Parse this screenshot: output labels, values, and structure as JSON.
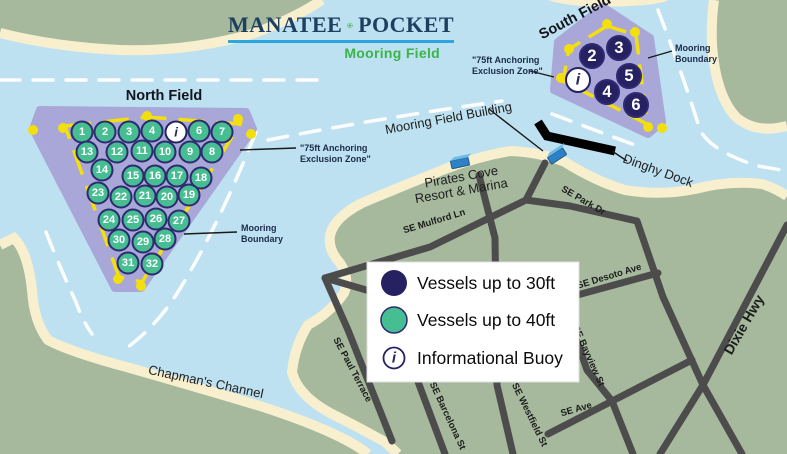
{
  "map_title": {
    "word_left": "MANATEE",
    "word_right": "POCKET",
    "subtitle": "Mooring Field"
  },
  "colors": {
    "water": "#BDE1F0",
    "sand": "#F8EFCE",
    "land": "#A6B99D",
    "field": "#A9A6D8",
    "yellow": "#F2DF0D",
    "street": "#4C4C4C",
    "navy": "#262262",
    "buoy_green": "#47BD92",
    "buoy_stroke": "#2E2A72",
    "title_navy": "#1D3F60",
    "title_green": "#3BB54A",
    "underline": "#2BA7E0",
    "dock_black": "#000000",
    "building_blue": "#2E81C4"
  },
  "north_field": {
    "label": "North Field",
    "buoys": [
      {
        "n": "1",
        "x": 82,
        "y": 132
      },
      {
        "n": "2",
        "x": 105,
        "y": 132
      },
      {
        "n": "3",
        "x": 129,
        "y": 132
      },
      {
        "n": "4",
        "x": 152,
        "y": 131
      },
      {
        "n": "i",
        "x": 176,
        "y": 132,
        "t": "i"
      },
      {
        "n": "6",
        "x": 199,
        "y": 131
      },
      {
        "n": "7",
        "x": 222,
        "y": 132
      },
      {
        "n": "13",
        "x": 87,
        "y": 152
      },
      {
        "n": "12",
        "x": 117,
        "y": 152
      },
      {
        "n": "11",
        "x": 142,
        "y": 151
      },
      {
        "n": "10",
        "x": 165,
        "y": 152
      },
      {
        "n": "9",
        "x": 190,
        "y": 152
      },
      {
        "n": "8",
        "x": 212,
        "y": 152
      },
      {
        "n": "14",
        "x": 102,
        "y": 170
      },
      {
        "n": "15",
        "x": 133,
        "y": 176
      },
      {
        "n": "16",
        "x": 155,
        "y": 176
      },
      {
        "n": "17",
        "x": 177,
        "y": 176
      },
      {
        "n": "18",
        "x": 201,
        "y": 178
      },
      {
        "n": "23",
        "x": 98,
        "y": 193
      },
      {
        "n": "22",
        "x": 121,
        "y": 197
      },
      {
        "n": "21",
        "x": 145,
        "y": 196
      },
      {
        "n": "20",
        "x": 167,
        "y": 197
      },
      {
        "n": "19",
        "x": 189,
        "y": 195
      },
      {
        "n": "24",
        "x": 109,
        "y": 220
      },
      {
        "n": "25",
        "x": 133,
        "y": 220
      },
      {
        "n": "26",
        "x": 156,
        "y": 219
      },
      {
        "n": "27",
        "x": 179,
        "y": 221
      },
      {
        "n": "30",
        "x": 119,
        "y": 240
      },
      {
        "n": "29",
        "x": 143,
        "y": 242
      },
      {
        "n": "28",
        "x": 165,
        "y": 239
      },
      {
        "n": "31",
        "x": 128,
        "y": 263
      },
      {
        "n": "32",
        "x": 152,
        "y": 264
      }
    ],
    "dots": [
      [
        33,
        130
      ],
      [
        63,
        128
      ],
      [
        147,
        116
      ],
      [
        238,
        119
      ],
      [
        251,
        134
      ],
      [
        118,
        279
      ],
      [
        141,
        286
      ]
    ]
  },
  "south_field": {
    "label": "South Field",
    "buoys": [
      {
        "n": "2",
        "x": 592,
        "y": 56
      },
      {
        "n": "3",
        "x": 619,
        "y": 48
      },
      {
        "n": "i",
        "x": 578,
        "y": 80,
        "t": "i"
      },
      {
        "n": "5",
        "x": 629,
        "y": 76
      },
      {
        "n": "4",
        "x": 607,
        "y": 92
      },
      {
        "n": "6",
        "x": 636,
        "y": 105
      }
    ],
    "dots": [
      [
        607,
        24
      ],
      [
        635,
        32
      ],
      [
        569,
        49
      ],
      [
        561,
        78
      ],
      [
        648,
        127
      ],
      [
        662,
        128
      ]
    ]
  },
  "callouts": {
    "north_exclusion_line1": "\"75ft Anchoring",
    "north_exclusion_line2": "Exclusion Zone\"",
    "south_exclusion_line1": "\"75ft Anchoring",
    "south_exclusion_line2": "Exclusion Zone\"",
    "north_boundary_line1": "Mooring",
    "north_boundary_line2": "Boundary",
    "south_boundary_line1": "Mooring",
    "south_boundary_line2": "Boundary"
  },
  "places": {
    "mooring_field_building": "Mooring Field Building",
    "dinghy_dock": "Dinghy Dock",
    "pirates_cove_line1": "Pirates Cove",
    "pirates_cove_line2": "Resort & Marina",
    "chapmans_channel": "Chapman's Channel"
  },
  "streets": {
    "mulford": "SE Mulford Ln",
    "park": "SE Park Dr",
    "desoto": "SE Desoto Ave",
    "bayview": "SE Bayview St",
    "westfield": "SE Westfield St",
    "ave": "SE  Ave",
    "paul": "SE Paul Terrace",
    "barcelona": "SE Barcelona St",
    "dixie": "Dixie Hwy"
  },
  "legend": {
    "info_glyph": "i",
    "items": [
      {
        "icon": "navy-circle",
        "label": "Vessels up to 30ft"
      },
      {
        "icon": "green-circle",
        "label": "Vessels up to 40ft"
      },
      {
        "icon": "info-buoy",
        "label": "Informational Buoy"
      }
    ]
  }
}
